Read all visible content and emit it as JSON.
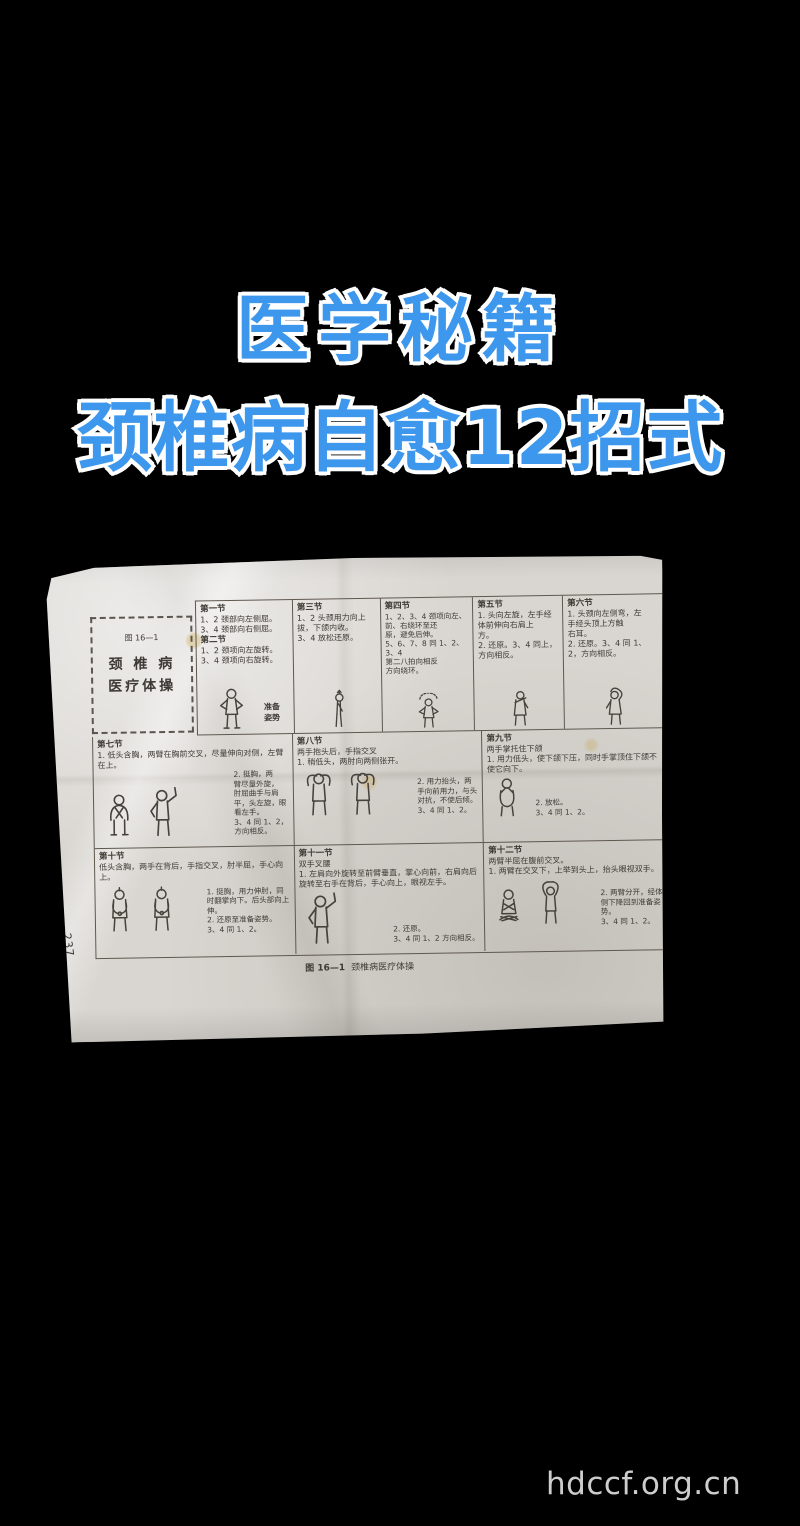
{
  "colors": {
    "background": "#000000",
    "title_blue": "#3d97ec",
    "title_outline": "#ffffff",
    "paper": "#d9d6d1"
  },
  "overlay": {
    "line1": "医学秘籍",
    "line2": "颈椎病自愈12招式"
  },
  "footer": {
    "watermark": "hdccf.org.cn"
  },
  "paper": {
    "page_number": "237",
    "title_box": {
      "fig": "图 16—1",
      "l1": "颈 椎 病",
      "l2": "医疗体操"
    },
    "caption": {
      "fig": "图 16—1",
      "text": "颈椎病医疗体操"
    },
    "sec1_2": {
      "h1": "第一节",
      "b1": "1、2 颈部向左侧屈。\n3、4 颈部向右侧屈。",
      "h2": "第二节",
      "b2": "1、2 颈项向左旋转。\n3、4 颈项向右旋转。",
      "figcap": "准备\n姿势"
    },
    "sec3": {
      "h": "第三节",
      "b": "1、2 头颈用力向上\n拔，下颌内收。\n3、4 放松还原。"
    },
    "sec4": {
      "h": "第四节",
      "b": "1、2、3、4 颈项向左、\n前、右绕环至还\n原，避免后伸。\n5、6、7、8 同 1、2、3、4\n第二八拍向相反\n方向绕环。"
    },
    "sec5": {
      "h": "第五节",
      "b": "1. 头向左旋，左手经\n体前伸向右肩上\n方。\n2. 还原。3、4 同上，\n方向相反。"
    },
    "sec6": {
      "h": "第六节",
      "b": "1. 头颈向左侧弯，左\n手经头顶上方触\n右耳。\n2. 还原。3、4 同 1、\n2，方向相反。"
    },
    "sec7": {
      "h": "第七节",
      "pre": "1. 低头含胸，两臂在胸前交叉，尽量伸向对侧，左臂在上。",
      "post": "2. 挺胸，两\n臂尽量外旋，\n肘屈曲手与肩\n平，头左旋，眼\n看左手。\n3、4 同 1、2，\n方向相反。"
    },
    "sec8": {
      "h": "第八节",
      "pre": "两手抱头后，手指交叉\n1. 稍低头，两肘向两侧张开。",
      "post": "2. 用力抬头，两\n手向前用力，与头\n对抗，不使后倾。\n3、4 同 1、2。"
    },
    "sec9": {
      "h": "第九节",
      "pre": "两手掌托住下颌\n1. 用力低头，使下颌下压，同时手掌顶住下颌不使它向下。",
      "post": "2. 放松。\n3、4 同 1、2。"
    },
    "sec10": {
      "h": "第十节",
      "pre": "低头含胸，两手在背后，手指交叉，肘半屈，手心向上。",
      "post": "1. 挺胸，用力伸肘，同\n时翻掌向下。后头部向上\n伸。\n2. 还原至准备姿势。\n3、4 同 1、2。"
    },
    "sec11": {
      "h": "第十一节",
      "pre": "双手叉腰\n1. 左肩向外旋转至前臂垂直，掌心向前，右肩向后旋转至右手在背后，手心向上，眼视左手。",
      "post": "2. 还原。\n3、4 同 1、2 方向相反。"
    },
    "sec12": {
      "h": "第十二节",
      "pre": "两臂半屈在腹前交叉。\n1. 两臂在交叉下，上举到头上，抬头眼视双手。",
      "post": "2. 两臂分开，经体\n侧下降回到准备姿\n势。\n3、4 同 1、2。"
    }
  }
}
